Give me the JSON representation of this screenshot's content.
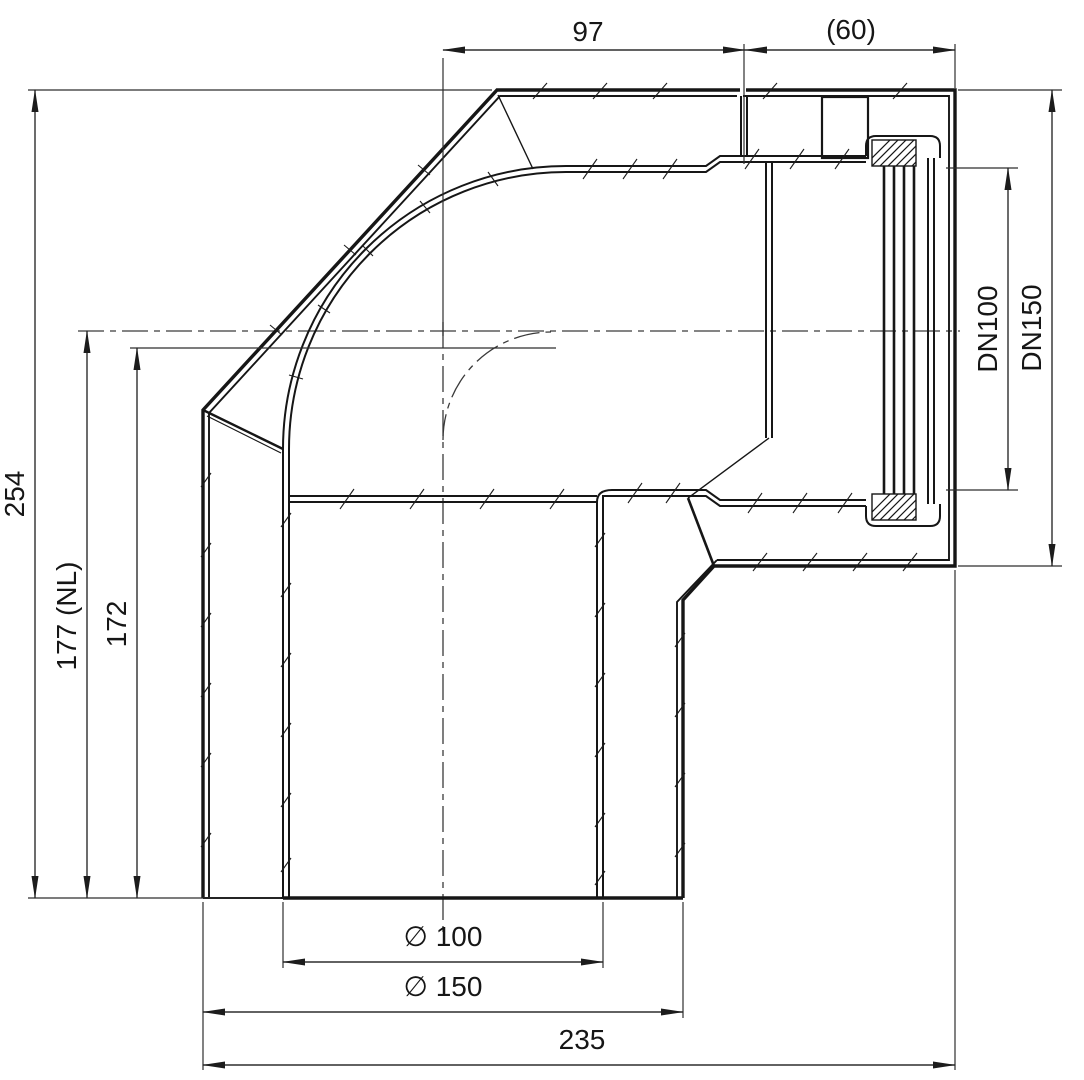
{
  "drawing": {
    "dims": {
      "top_length": "97",
      "socket_depth": "(60)",
      "overall_height": "254",
      "height_nl": "177 (NL)",
      "height_center": "172",
      "dn_inner": "DN100",
      "dn_outer": "DN150",
      "dia_inner": "∅ 100",
      "dia_outer": "∅ 150",
      "overall_length": "235"
    }
  }
}
